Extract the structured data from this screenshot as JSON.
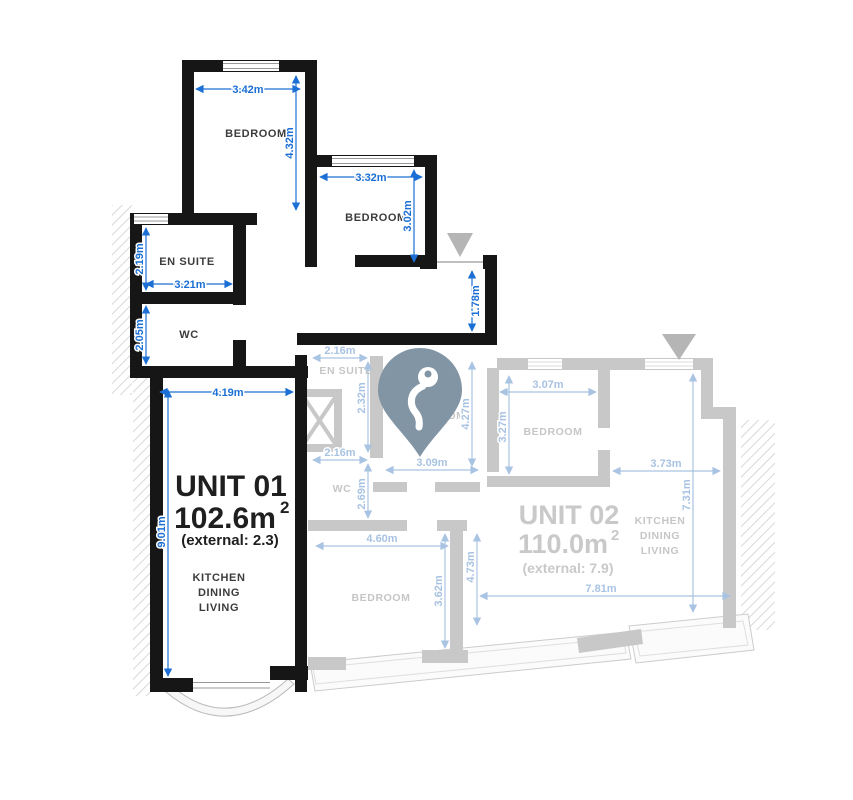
{
  "plan_title": "Two-unit apartment floor plan",
  "colors": {
    "dim_blue": "#1c6fd4",
    "dim_blue_faded": "#a9c3e2",
    "wall_black": "#161616",
    "wall_gray": "#c8c8c8",
    "room_text_gray": "#c6c6c6",
    "pin": "#8295a5",
    "entrance_triangle": "#b5b5b5"
  },
  "unit1": {
    "title": "UNIT 01",
    "area": "102.6m",
    "area_sup": "2",
    "external": "(external: 2.3)",
    "rooms": {
      "bedroom1": "BEDROOM",
      "bedroom2": "BEDROOM",
      "ensuite": "EN SUITE",
      "wc": "WC",
      "kitchen": [
        "KITCHEN",
        "DINING",
        "LIVING"
      ]
    },
    "dims": {
      "bedroom1_width": "3.42m",
      "bedroom1_depth": "4.32m",
      "bedroom2_width": "3.32m",
      "bedroom2_depth": "3.02m",
      "ensuite_depth": "2.19m",
      "ensuite_width": "3.21m",
      "wc_depth": "2.05m",
      "hall_width": "4.19m",
      "entry_width": "1.78m",
      "living_depth": "9.01m"
    }
  },
  "unit2": {
    "title": "UNIT 02",
    "area": "110.0m",
    "area_sup": "2",
    "external": "(external: 7.9)",
    "rooms": {
      "ensuite": "EN SUITE",
      "wc": "WC",
      "bedroom_center": "BEDROOM",
      "bedroom_top": "BEDROOM",
      "bedroom_bottom": "BEDROOM",
      "kitchen": [
        "KITCHEN",
        "DINING",
        "LIVING"
      ]
    },
    "dims": {
      "ensuite_width": "2.16m",
      "ensuite_depth": "2.32m",
      "wc_width": "2.16m",
      "wc_depth": "2.69m",
      "bedroom_center_width": "3.09m",
      "bedroom_center_depth": "4.27m",
      "bedroom_top_width": "3.07m",
      "bedroom_top_depth": "3.27m",
      "kitchen_width": "3.73m",
      "kitchen_depth": "7.31m",
      "bedroom_bottom_width": "4.60m",
      "bedroom_bottom_inner_depth": "3.62m",
      "bedroom_bottom_depth": "4.73m",
      "unit_width": "7.81m"
    }
  }
}
